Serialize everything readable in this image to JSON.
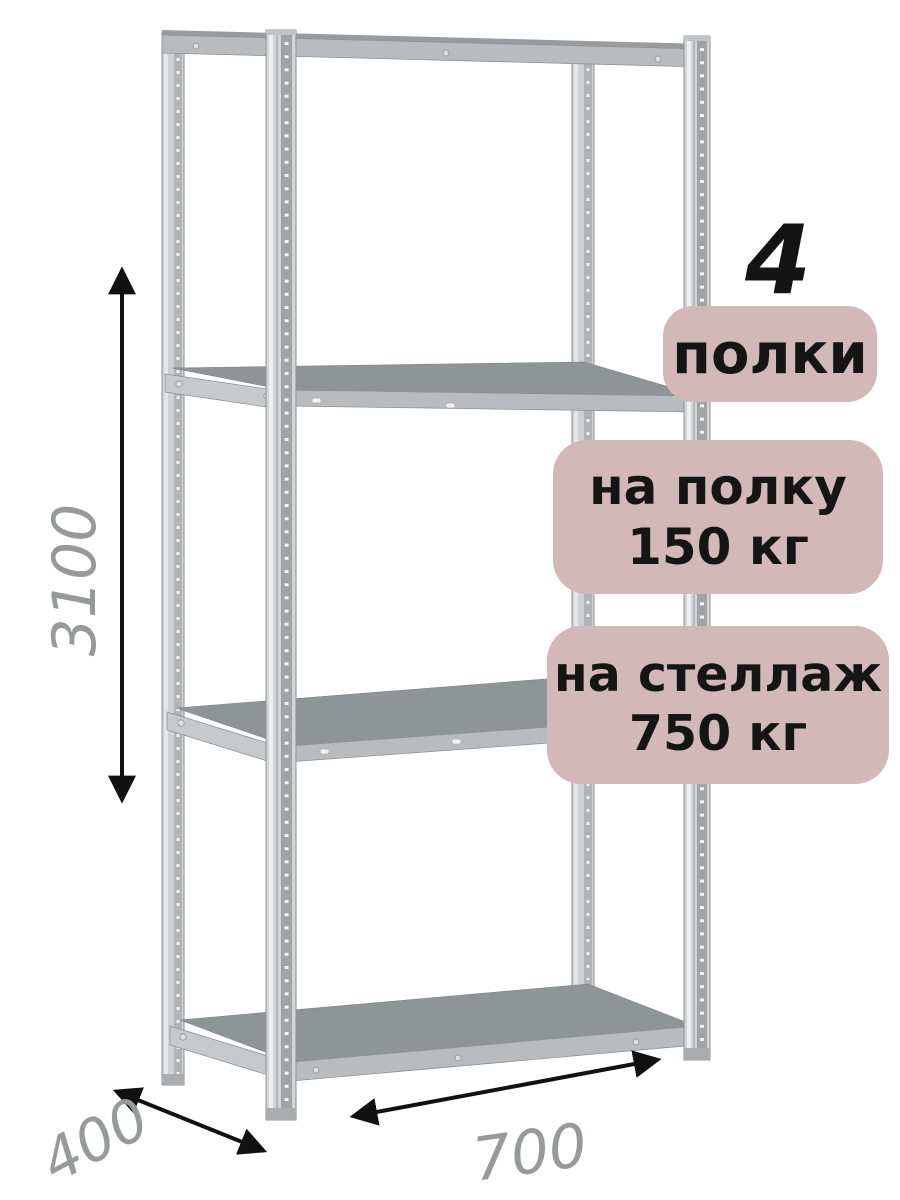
{
  "badges": {
    "count": {
      "value": "4",
      "label": "полки"
    },
    "per_shelf": {
      "line1": "на полку",
      "line2": "150 кг"
    },
    "per_rack": {
      "line1": "на стеллаж",
      "line2": "750 кг"
    }
  },
  "dimensions": {
    "height_mm": "3100",
    "depth_mm": "400",
    "width_mm": "700"
  },
  "colors": {
    "badge_bg": "#d2b8b8",
    "badge_text": "#151515",
    "dimension_text": "#97999b",
    "arrow": "#111111",
    "background": "#ffffff"
  }
}
